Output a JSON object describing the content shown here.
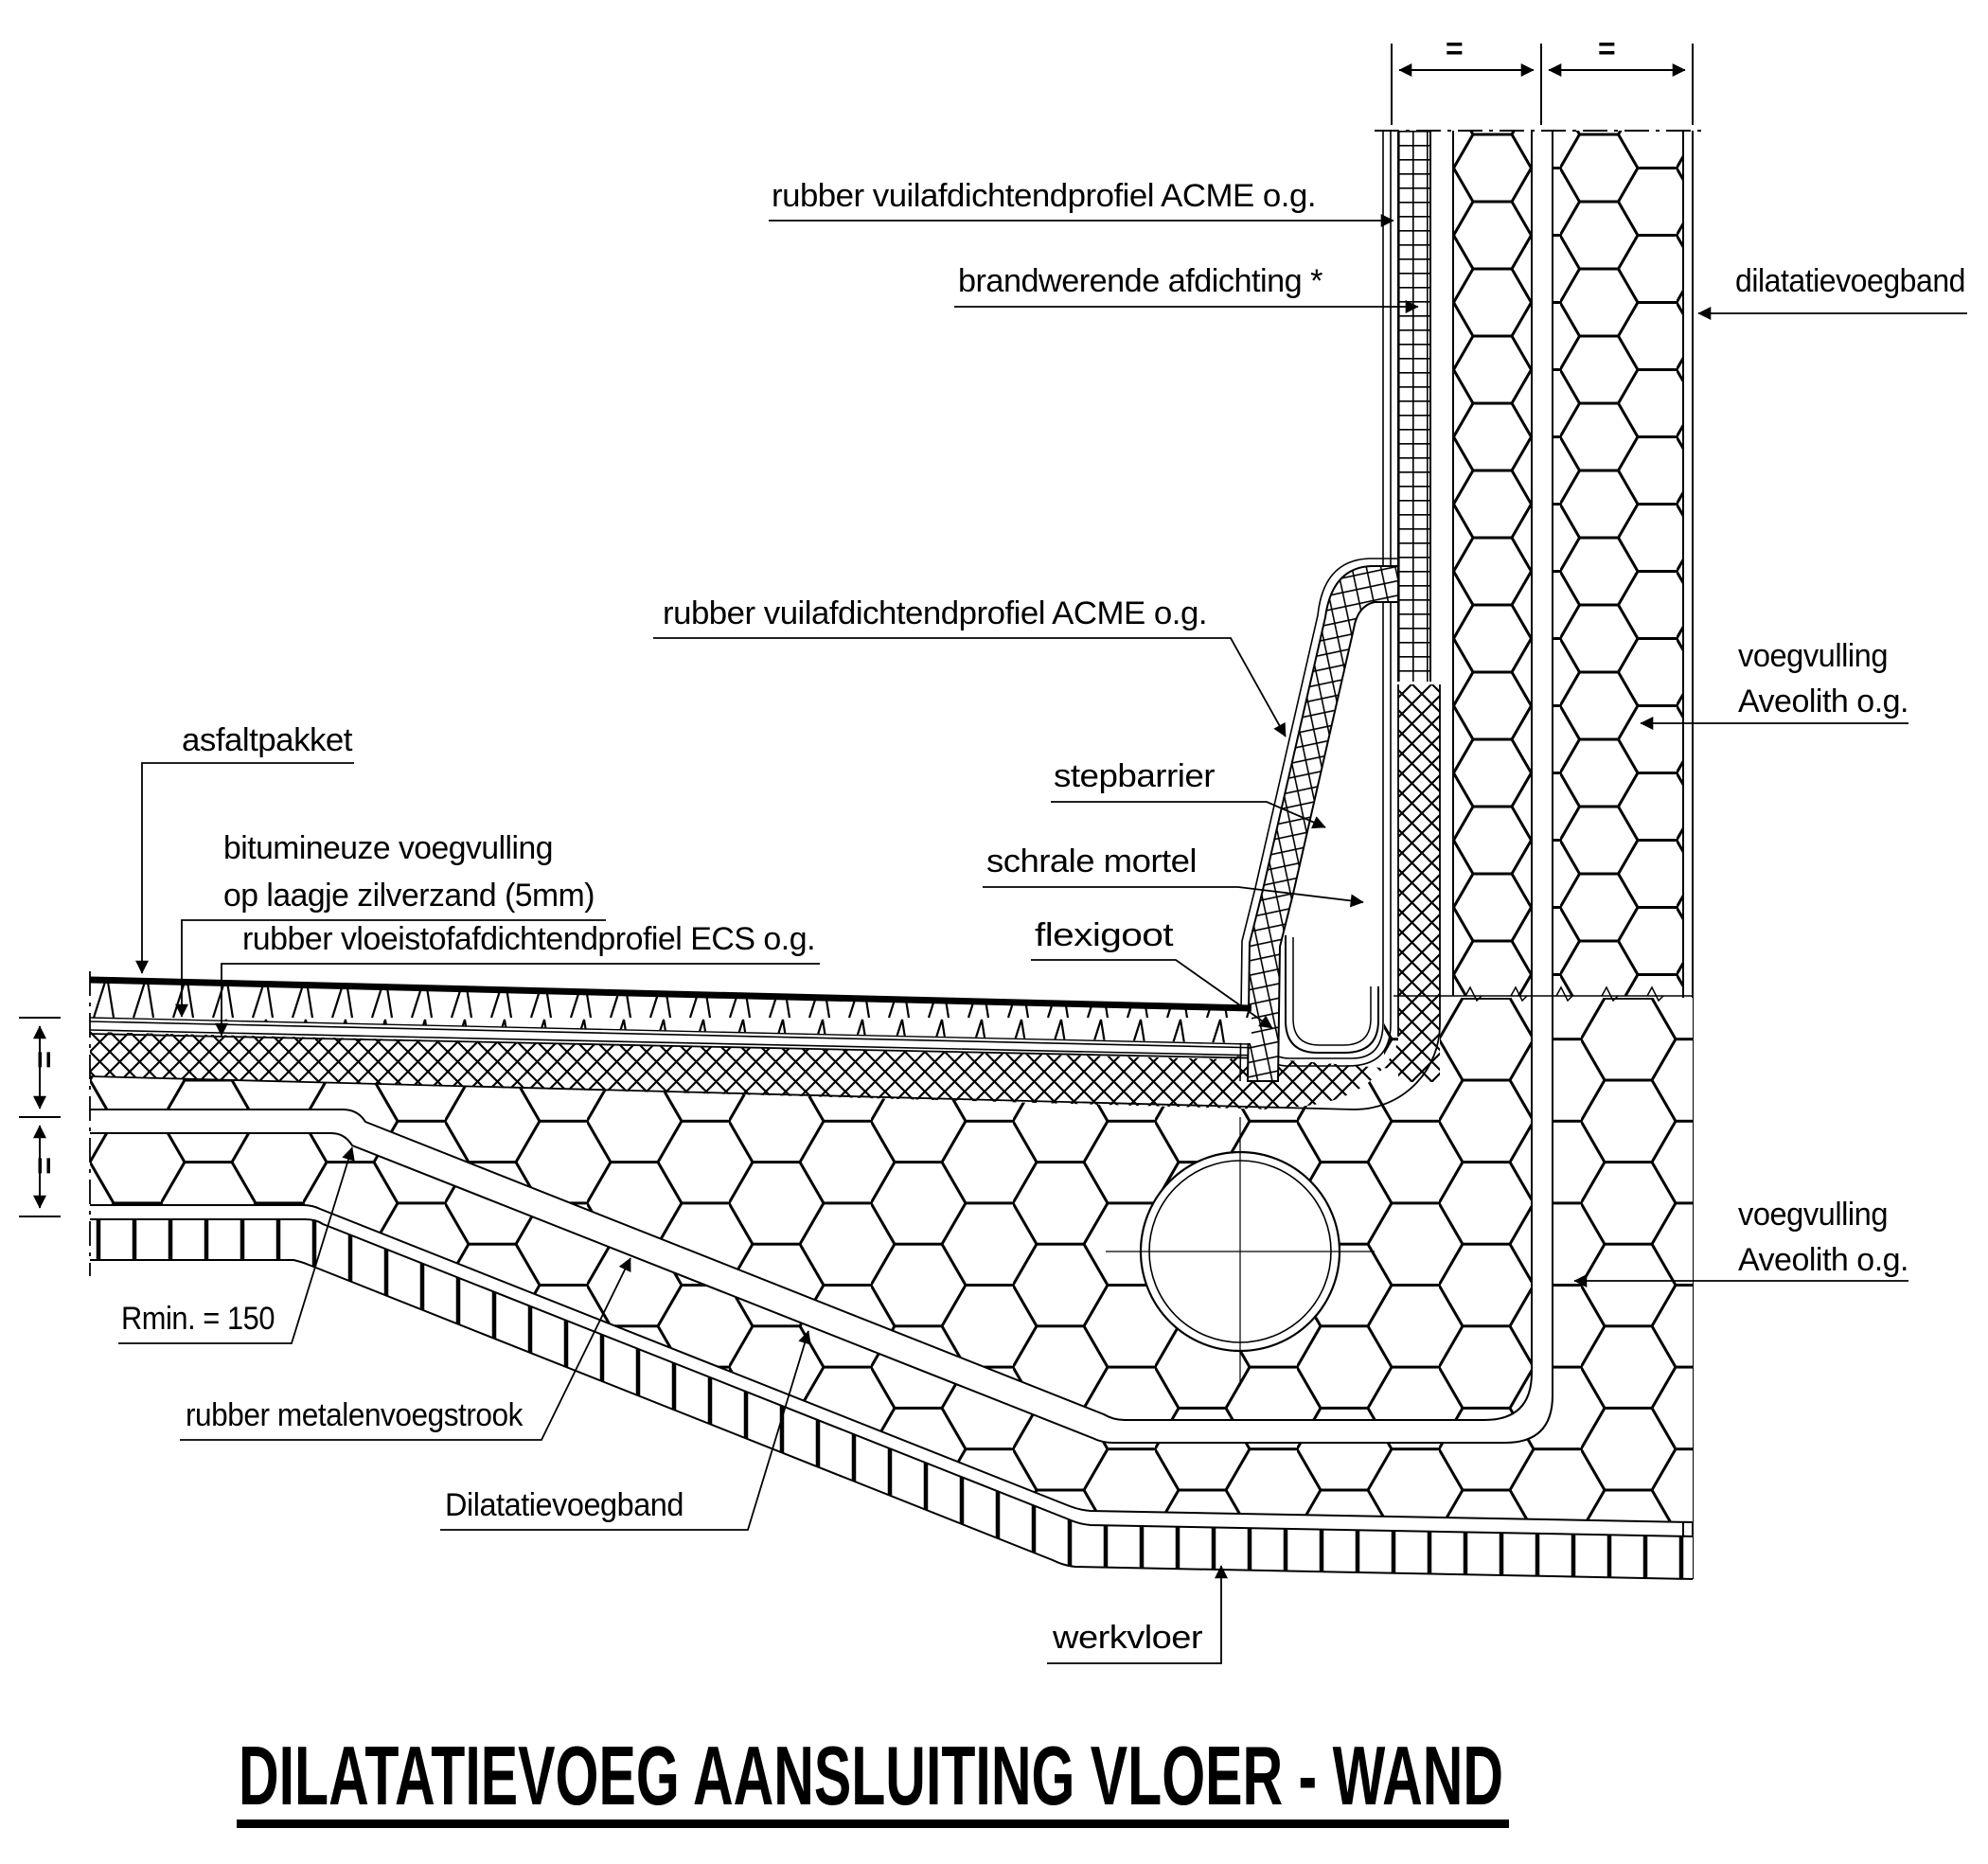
{
  "title": {
    "text": "DILATATIEVOEG AANSLUITING VLOER - WAND"
  },
  "labels": {
    "rubber_profile_top": "rubber vuilafdichtendprofiel ACME o.g.",
    "fire_seal": "brandwerende afdichting *",
    "dilatation_band_wall": "dilatatievoegband",
    "rubber_profile_mid": "rubber vuilafdichtendprofiel ACME o.g.",
    "stepbarrier": "stepbarrier",
    "lean_mortar": "schrale mortel",
    "flexi_gutter": "flexigoot",
    "joint_fill_wall_line1": "voegvulling",
    "joint_fill_wall_line2": "Aveolith o.g.",
    "joint_fill_floor_line1": "voegvulling",
    "joint_fill_floor_line2": "Aveolith o.g.",
    "asphalt_package": "asfaltpakket",
    "bitumen_fill_line1": "bitumineuze voegvulling",
    "bitumen_fill_line2": "op laagje zilverzand (5mm)",
    "liquid_seal_profile": "rubber vloeistofafdichtendprofiel ECS o.g.",
    "min_radius": "Rmin. = 150",
    "rubber_metal_strip": "rubber metalenvoegstrook",
    "dilatation_band_floor": "Dilatatievoegband",
    "work_floor": "werkvloer"
  },
  "symbols": {
    "equal_mark": "="
  },
  "colors": {
    "ink": "#000000",
    "paper": "#ffffff"
  }
}
